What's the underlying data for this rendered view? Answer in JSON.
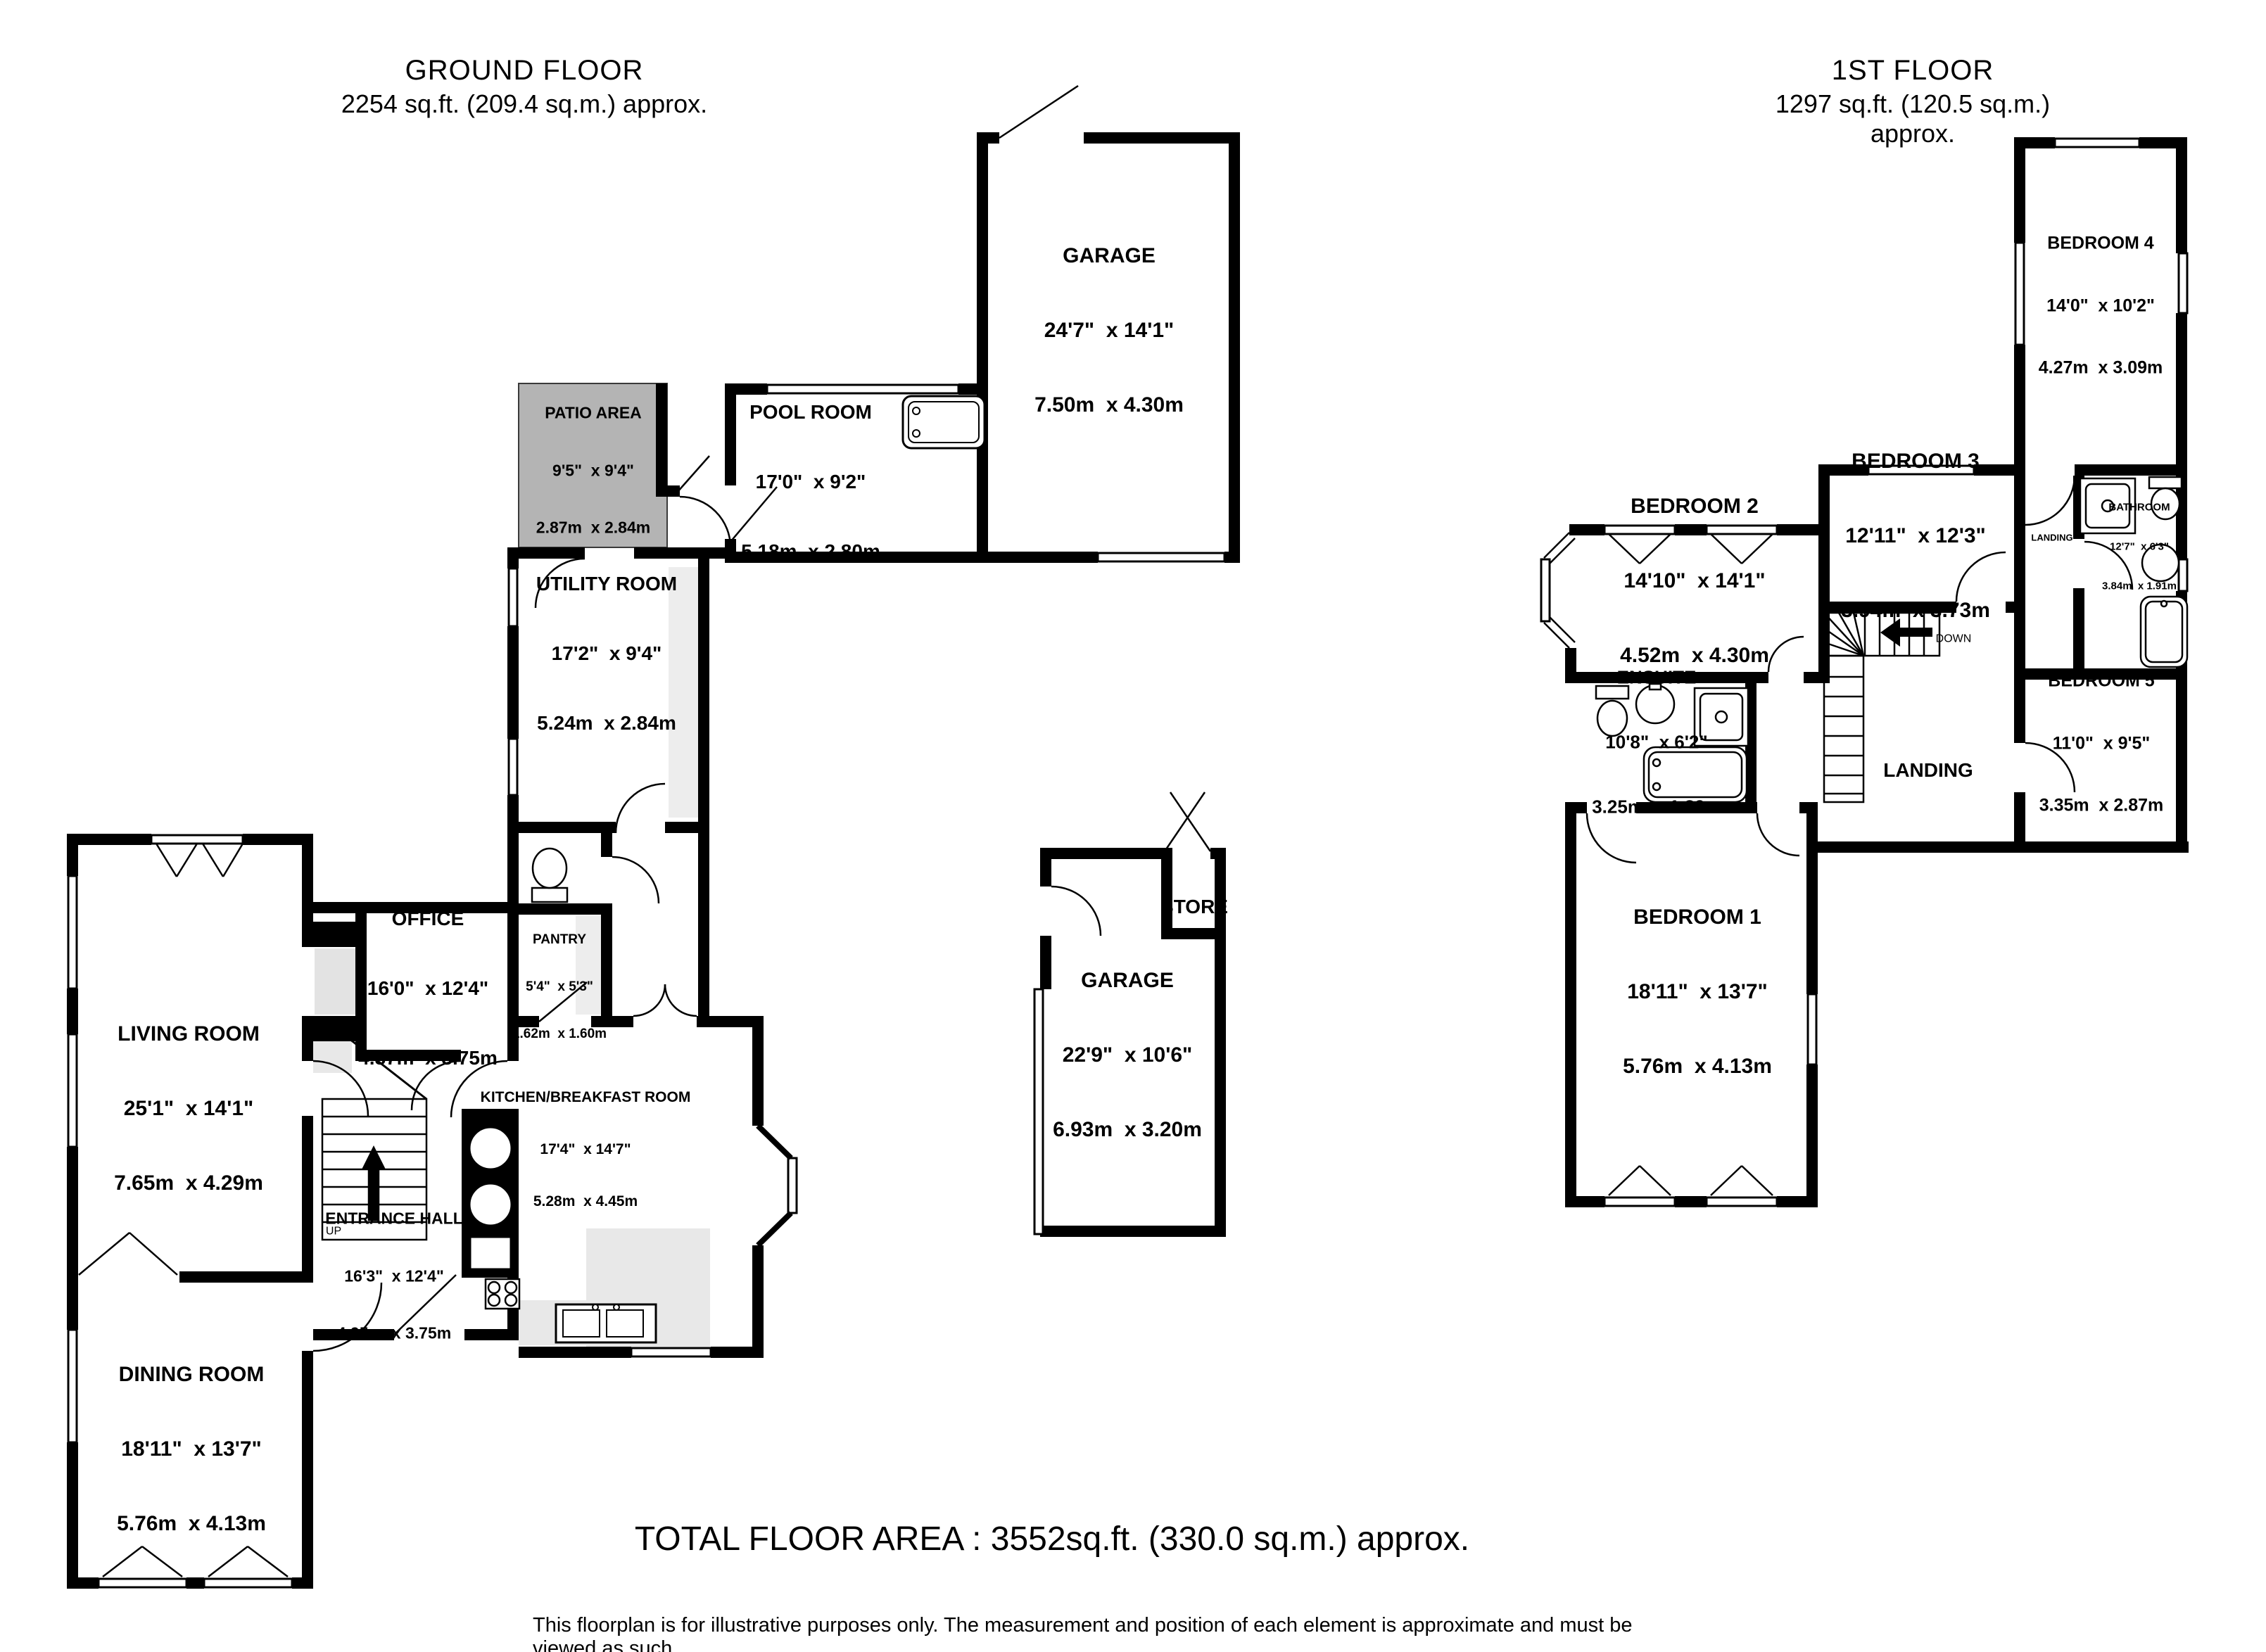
{
  "floors": {
    "ground": {
      "title": "GROUND FLOOR",
      "area": "2254 sq.ft. (209.4 sq.m.) approx.",
      "rooms": {
        "garage": {
          "name": "GARAGE",
          "imperial": "24'7\"  x 14'1\"",
          "metric": "7.50m  x 4.30m"
        },
        "pool_room": {
          "name": "POOL ROOM",
          "imperial": "17'0\"  x 9'2\"",
          "metric": "5.18m  x 2.80m"
        },
        "patio": {
          "name": "PATIO AREA",
          "imperial": "9'5\"  x 9'4\"",
          "metric": "2.87m  x 2.84m"
        },
        "utility": {
          "name": "UTILITY ROOM",
          "imperial": "17'2\"  x 9'4\"",
          "metric": "5.24m  x 2.84m"
        },
        "office": {
          "name": "OFFICE",
          "imperial": "16'0\"  x 12'4\"",
          "metric": "4.87m  x 3.75m"
        },
        "pantry": {
          "name": "PANTRY",
          "imperial": "5'4\"  x 5'3\"",
          "metric": "1.62m  x 1.60m"
        },
        "living": {
          "name": "LIVING ROOM",
          "imperial": "25'1\"  x 14'1\"",
          "metric": "7.65m  x 4.29m"
        },
        "entrance": {
          "name": "ENTRANCE HALL",
          "imperial": "16'3\"  x 12'4\"",
          "metric": "4.95m  x 3.75m"
        },
        "kitchen": {
          "name": "KITCHEN/BREAKFAST ROOM",
          "imperial": "17'4\"  x 14'7\"",
          "metric": "5.28m  x 4.45m"
        },
        "dining": {
          "name": "DINING ROOM",
          "imperial": "18'11\"  x 13'7\"",
          "metric": "5.76m  x 4.13m"
        },
        "rear_garage": {
          "name": "GARAGE",
          "imperial": "22'9\"  x 10'6\"",
          "metric": "6.93m  x 3.20m"
        },
        "store": {
          "name": "STORE"
        }
      },
      "stairs_label": "UP"
    },
    "first": {
      "title": "1ST FLOOR",
      "area": "1297 sq.ft. (120.5 sq.m.) approx.",
      "rooms": {
        "bedroom1": {
          "name": "BEDROOM 1",
          "imperial": "18'11\"  x 13'7\"",
          "metric": "5.76m  x 4.13m"
        },
        "bedroom2": {
          "name": "BEDROOM 2",
          "imperial": "14'10\"  x 14'1\"",
          "metric": "4.52m  x 4.30m"
        },
        "bedroom3": {
          "name": "BEDROOM 3",
          "imperial": "12'11\"  x 12'3\"",
          "metric": "3.94m  x 3.73m"
        },
        "bedroom4": {
          "name": "BEDROOM 4",
          "imperial": "14'0\"  x 10'2\"",
          "metric": "4.27m  x 3.09m"
        },
        "bedroom5": {
          "name": "BEDROOM 5",
          "imperial": "11'0\"  x 9'5\"",
          "metric": "3.35m  x 2.87m"
        },
        "bathroom": {
          "name": "BATHROOM",
          "imperial": "12'7\"  x 6'3\"",
          "metric": "3.84m  x 1.91m"
        },
        "ensuite": {
          "name": "ENSUITE",
          "imperial": "10'8\"  x 6'2\"",
          "metric": "3.25m  x 1.89m"
        },
        "landing": {
          "name": "LANDING"
        },
        "landing_small": {
          "name": "LANDING"
        }
      },
      "stairs_label": "DOWN"
    }
  },
  "footer": {
    "total": "TOTAL FLOOR AREA : 3552sq.ft. (330.0 sq.m.) approx.",
    "disclaimer": "This floorplan is for illustrative purposes only. The measurement and position of each element is approximate and must be viewed as such"
  },
  "colors": {
    "wall": "#000000",
    "patio_fill": "#b4b4b4",
    "counter_fill": "#e8e8e8"
  }
}
